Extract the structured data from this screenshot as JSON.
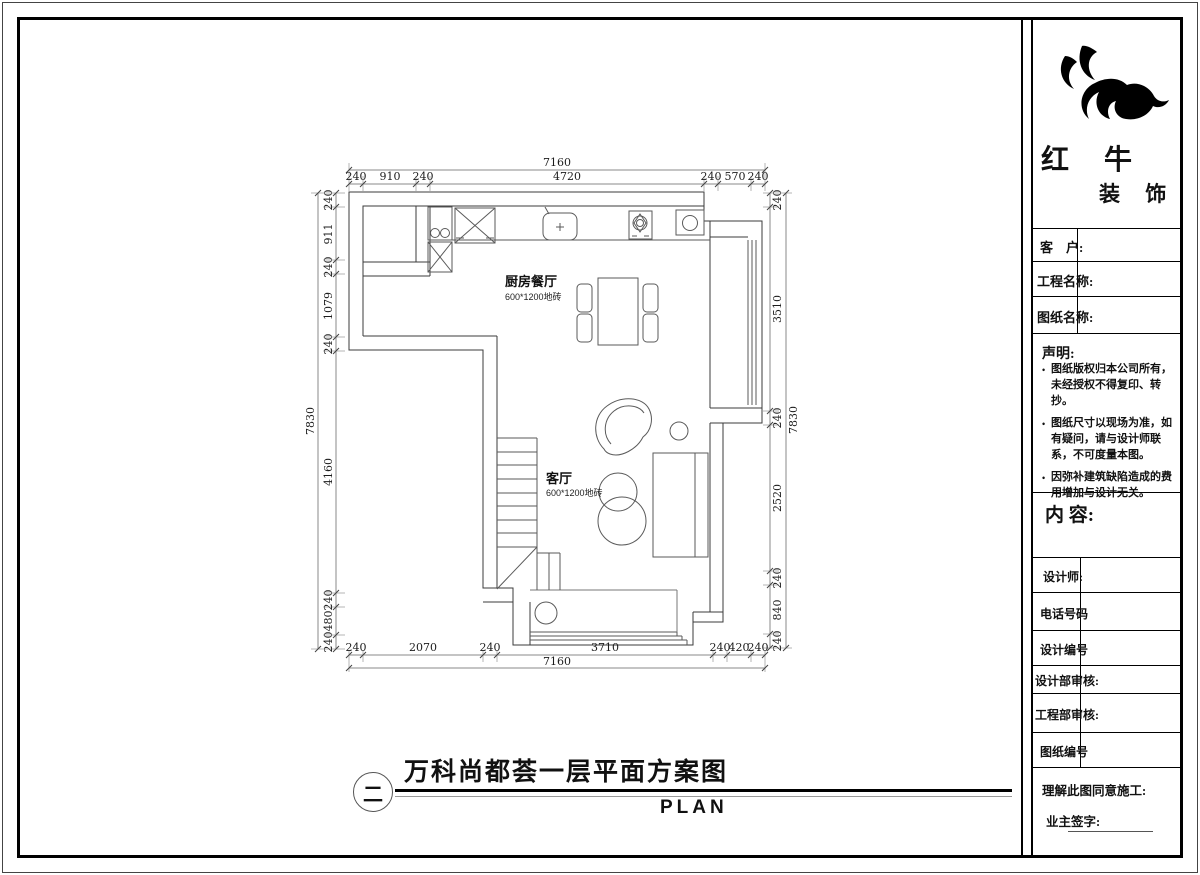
{
  "plan": {
    "rooms": {
      "kitchen": {
        "name": "厨房餐厅",
        "floor": "600*1200地砖"
      },
      "living": {
        "name": "客厅",
        "floor": "600*1200地砖"
      }
    },
    "dims": {
      "top": {
        "total": "7160",
        "segs": [
          "240",
          "910",
          "240",
          "4720",
          "240",
          "570",
          "240"
        ]
      },
      "bottom": {
        "total": "7160",
        "segs": [
          "240",
          "2070",
          "240",
          "3710",
          "240",
          "420",
          "240"
        ]
      },
      "left": {
        "total": "7830",
        "segs": [
          "240",
          "911",
          "240",
          "1079",
          "240",
          "4160",
          "240",
          "480",
          "240"
        ]
      },
      "right": {
        "total": "7830",
        "segs": [
          "240",
          "3510",
          "240",
          "2520",
          "240",
          "840",
          "240"
        ]
      }
    }
  },
  "caption": {
    "index": "二",
    "title": "万科尚都荟一层平面方案图",
    "subtitle": "PLAN"
  },
  "titleblock": {
    "brand": {
      "line1": "红 牛",
      "line2": "装 饰"
    },
    "fields": {
      "client": "客　户:",
      "project": "工程名称:",
      "drawing": "图纸名称:"
    },
    "statement": {
      "title": "声明:",
      "items": [
        "图纸版权归本公司所有，未经授权不得复印、转抄。",
        "图纸尺寸以现场为准，如有疑问，请与设计师联系，不可度量本图。",
        "因弥补建筑缺陷造成的费用增加与设计无关。"
      ]
    },
    "content_label": "内 容:",
    "rows": {
      "designer": "设计师:",
      "phone": "电话号码",
      "design_no": "设计编号",
      "design_review": "设计部审核:",
      "eng_review": "工程部审核:",
      "drawing_no": "图纸编号"
    },
    "footer": {
      "agree": "理解此图同意施工:",
      "sign": "业主签字:"
    }
  }
}
